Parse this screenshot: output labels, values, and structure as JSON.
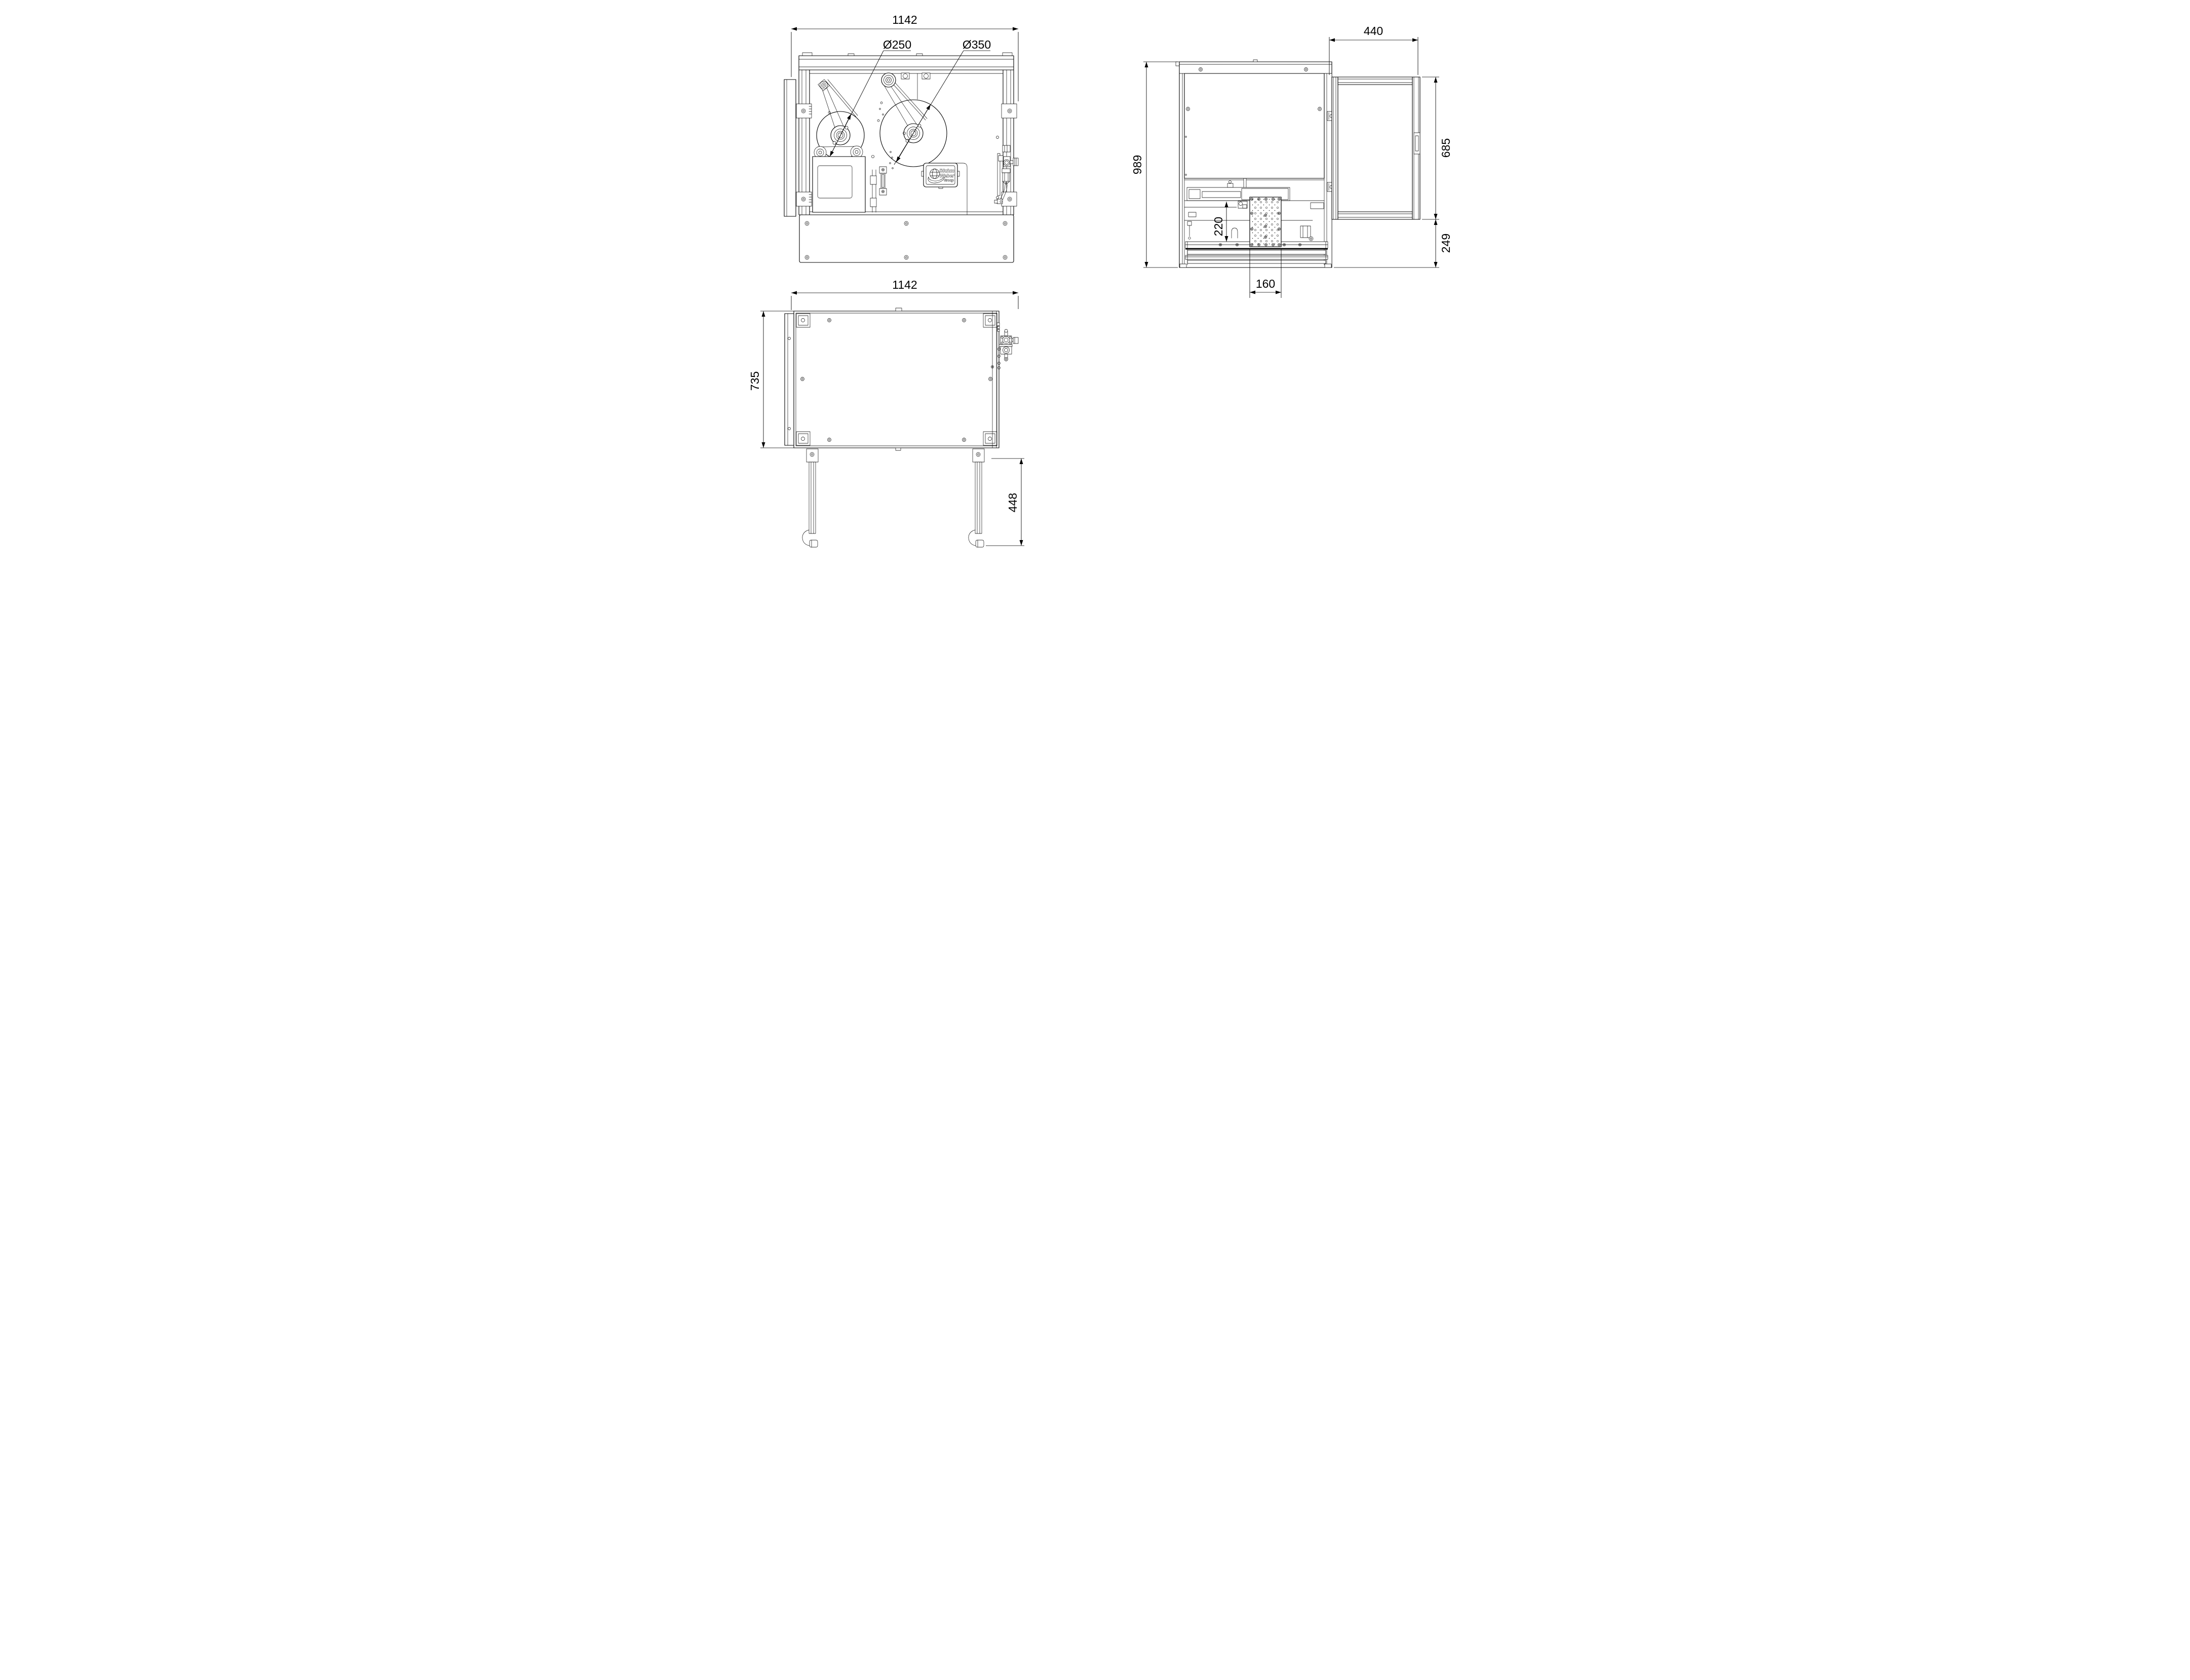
{
  "drawing": {
    "background": "#ffffff",
    "line_color": "#000000"
  },
  "views": {
    "front": {
      "dims": {
        "overall_width": "1142",
        "roll_small": "Ø250",
        "roll_large": "Ø350"
      },
      "logo": {
        "line1": "Bluhm",
        "line2": "Weber",
        "line3": "Group"
      }
    },
    "side": {
      "dims": {
        "door_width": "440",
        "overall_height": "989",
        "door_height": "685",
        "lower_height": "249",
        "clearance": "220",
        "pad_width": "160"
      }
    },
    "top": {
      "dims": {
        "overall_width": "1142",
        "depth": "735",
        "leg_length": "448"
      }
    }
  }
}
